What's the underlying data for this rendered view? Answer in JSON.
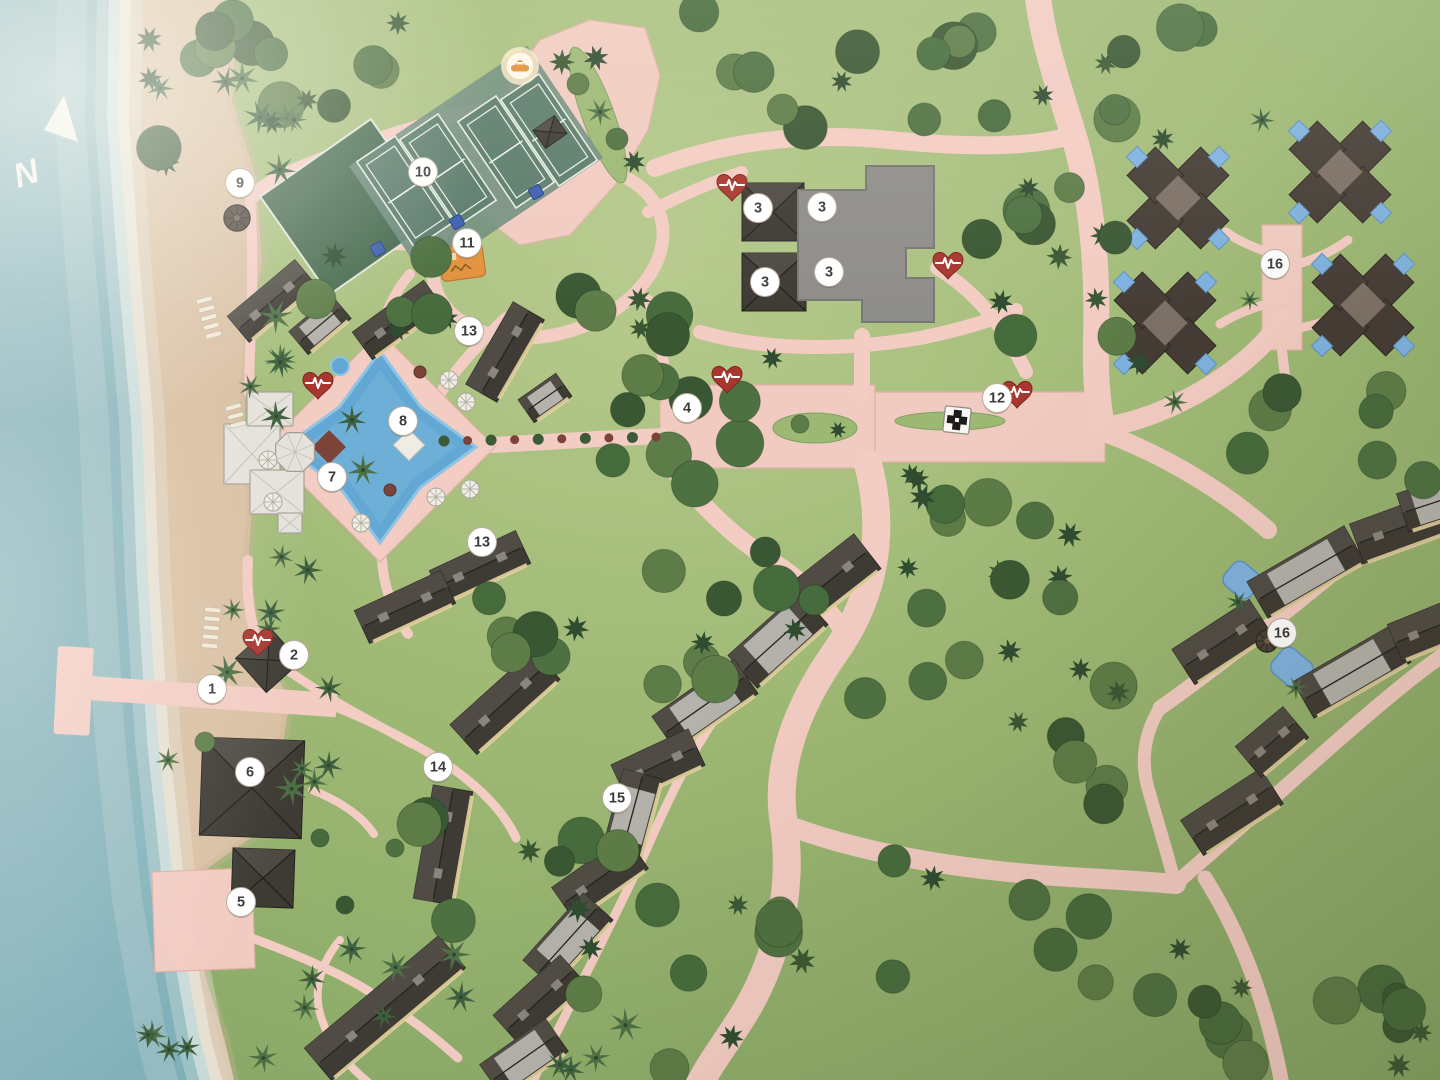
{
  "scene": {
    "width": 1440,
    "height": 1080,
    "kind": "illustrated resort site map (photo)"
  },
  "palette": {
    "ocean_deep": "#7eafb9",
    "ocean_mid": "#8fb7bd",
    "ocean_pale": "#b9d2d2",
    "foam": "#ecf1ea",
    "sand": "#d9c0a3",
    "sand_wet": "#cbb294",
    "grass": "#9db873",
    "grass_light": "#b7ca8d",
    "grass_dark": "#7fa162",
    "forest_dark": "#3a5733",
    "forest_mid": "#4e7141",
    "forest_alt": "#5d7c47",
    "forest_deep": "#2f4c31",
    "palm_green": "#4e7046",
    "palm_dark": "#3f6140",
    "path": "#f3ccc3",
    "path_edge": "#e2b1a6",
    "roof_dark": "#3e3a34",
    "roof_mid": "#57534b",
    "panel_light": "#b4b2ac",
    "trim_cream": "#e3d1a0",
    "flat_roof": "#8e8d8a",
    "flat_edge": "#63625f",
    "white_bldg": "#e4e2db",
    "white_line": "#a09c93",
    "pool_blue": "#63a8d4",
    "pool_light": "#8ec4e4",
    "villa_pool": "#7fb2e0",
    "court_green": "#5c7c6c",
    "court_apron": "#6f8d7d",
    "court_line": "#e9efe8",
    "lawn_green": "#476a4f",
    "marker_bg": "#ffffff",
    "marker_text": "#3b3b3b",
    "marker_ring": "#b9ad9f",
    "aed_red": "#a93730",
    "orange": "#e2923c",
    "maroon": "#7c4338",
    "sign_dark": "#1d1b18"
  },
  "compass": {
    "label": "N"
  },
  "markers": [
    {
      "n": "1",
      "x": 212,
      "y": 689
    },
    {
      "n": "2",
      "x": 294,
      "y": 655
    },
    {
      "n": "3",
      "x": 758,
      "y": 208
    },
    {
      "n": "3",
      "x": 822,
      "y": 207
    },
    {
      "n": "3",
      "x": 765,
      "y": 282
    },
    {
      "n": "3",
      "x": 829,
      "y": 272
    },
    {
      "n": "4",
      "x": 687,
      "y": 408
    },
    {
      "n": "5",
      "x": 241,
      "y": 902
    },
    {
      "n": "6",
      "x": 250,
      "y": 772
    },
    {
      "n": "7",
      "x": 332,
      "y": 477
    },
    {
      "n": "8",
      "x": 403,
      "y": 421
    },
    {
      "n": "9",
      "x": 240,
      "y": 183
    },
    {
      "n": "10",
      "x": 423,
      "y": 172
    },
    {
      "n": "11",
      "x": 467,
      "y": 243
    },
    {
      "n": "12",
      "x": 997,
      "y": 398
    },
    {
      "n": "13",
      "x": 469,
      "y": 331
    },
    {
      "n": "13",
      "x": 482,
      "y": 542
    },
    {
      "n": "14",
      "x": 438,
      "y": 767
    },
    {
      "n": "15",
      "x": 617,
      "y": 798
    },
    {
      "n": "16",
      "x": 1275,
      "y": 264
    },
    {
      "n": "16",
      "x": 1282,
      "y": 633
    }
  ],
  "aed_icons": [
    [
      318,
      385
    ],
    [
      732,
      187
    ],
    [
      948,
      265
    ],
    [
      727,
      379
    ],
    [
      1017,
      394
    ],
    [
      258,
      642
    ]
  ],
  "car_icon": {
    "x": 520,
    "y": 66
  },
  "medic_sign": {
    "x": 957,
    "y": 420
  },
  "terrain": {
    "waterline": [
      [
        120,
        -5
      ],
      [
        118,
        120
      ],
      [
        128,
        260
      ],
      [
        142,
        420
      ],
      [
        148,
        580
      ],
      [
        158,
        740
      ],
      [
        175,
        900
      ],
      [
        200,
        1040
      ],
      [
        212,
        1085
      ]
    ],
    "grassline": [
      [
        238,
        -5
      ],
      [
        232,
        100
      ],
      [
        256,
        178
      ],
      [
        262,
        262
      ],
      [
        248,
        342
      ],
      [
        244,
        424
      ],
      [
        252,
        505
      ],
      [
        247,
        582
      ],
      [
        260,
        645
      ],
      [
        290,
        700
      ],
      [
        280,
        762
      ],
      [
        262,
        830
      ],
      [
        205,
        870
      ],
      [
        195,
        905
      ],
      [
        205,
        975
      ],
      [
        225,
        1040
      ],
      [
        235,
        1085
      ]
    ]
  },
  "plazas": [
    {
      "pts": [
        [
          497,
          100
        ],
        [
          540,
          40
        ],
        [
          590,
          20
        ],
        [
          645,
          28
        ],
        [
          660,
          75
        ],
        [
          648,
          130
        ],
        [
          615,
          185
        ],
        [
          570,
          235
        ],
        [
          520,
          245
        ],
        [
          480,
          215
        ],
        [
          462,
          160
        ]
      ]
    },
    {
      "pts": [
        [
          660,
          385
        ],
        [
          875,
          385
        ],
        [
          875,
          468
        ],
        [
          660,
          468
        ]
      ]
    },
    {
      "pts": [
        [
          875,
          392
        ],
        [
          1105,
          392
        ],
        [
          1105,
          462
        ],
        [
          875,
          462
        ]
      ]
    },
    {
      "pts": [
        [
          1262,
          225
        ],
        [
          1302,
          225
        ],
        [
          1302,
          350
        ],
        [
          1262,
          350
        ]
      ]
    },
    {
      "pts": [
        [
          152,
          872
        ],
        [
          252,
          868
        ],
        [
          255,
          968
        ],
        [
          155,
          972
        ]
      ]
    }
  ],
  "medians": [
    {
      "type": "ellipse",
      "cx": 815,
      "cy": 428,
      "rx": 42,
      "ry": 15,
      "rot": 0
    },
    {
      "type": "ellipse",
      "cx": 950,
      "cy": 421,
      "rx": 55,
      "ry": 9,
      "rot": 0
    },
    {
      "type": "ellipse",
      "cx": 598,
      "cy": 115,
      "rx": 16,
      "ry": 72,
      "rot": -20
    }
  ],
  "roads": [
    {
      "d": "M 1037,-10 C 1042,40 1060,90 1075,140 C 1092,200 1098,270 1096,340 C 1095,375 1098,405 1102,427",
      "w": 26
    },
    {
      "d": "M 655,168 C 730,140 810,132 890,140 C 960,147 1020,148 1062,138",
      "w": 18
    },
    {
      "d": "M 700,332 C 770,352 850,350 920,338 C 960,330 992,320 1016,310",
      "w": 14
    },
    {
      "d": "M 862,336 L 862,394",
      "w": 16
    },
    {
      "d": "M 937,268 C 977,292 1006,330 1026,372",
      "w": 14
    },
    {
      "d": "M 1105,427 C 1150,420 1205,395 1248,358 C 1266,342 1276,330 1282,318",
      "w": 20
    },
    {
      "d": "M 1102,432 C 1165,455 1225,492 1268,530",
      "w": 18
    },
    {
      "d": "M 1160,708 C 1235,655 1320,585 1398,520 C 1420,503 1436,492 1448,486",
      "w": 15
    },
    {
      "d": "M 1175,884 C 1250,820 1332,743 1402,686 C 1424,668 1440,657 1450,650",
      "w": 15
    },
    {
      "d": "M 1160,708 C 1143,735 1140,765 1150,795 C 1158,824 1168,855 1175,884",
      "w": 13
    },
    {
      "d": "M 1205,878 C 1243,938 1268,1008 1282,1085",
      "w": 15
    },
    {
      "d": "M 868,464 C 888,540 870,604 834,654 C 798,706 774,766 784,824 C 794,892 776,962 744,1014 C 724,1046 708,1066 698,1088",
      "w": 28
    },
    {
      "d": "M 666,460 C 700,505 732,536 770,560 C 806,582 832,612 848,638",
      "w": 18
    },
    {
      "d": "M 784,824 C 868,856 976,872 1086,878 C 1122,880 1152,882 1176,884",
      "w": 20
    },
    {
      "d": "M 598,88 C 585,115 572,145 562,172",
      "w": 13
    },
    {
      "d": "M 648,300 C 660,330 664,360 666,392",
      "w": 11
    },
    {
      "d": "M 505,318 C 475,348 453,372 440,394",
      "w": 11
    },
    {
      "d": "M 437,248 C 415,246 395,245 378,244",
      "w": 10
    },
    {
      "d": "M 648,212 C 680,196 712,182 742,172",
      "w": 12
    },
    {
      "d": "M 497,105 C 432,122 362,142 305,166 C 280,176 262,186 252,197",
      "w": 14
    },
    {
      "d": "M 250,197 C 255,260 250,330 249,392",
      "w": 10
    },
    {
      "d": "M 248,560 C 246,592 250,620 258,644",
      "w": 10
    },
    {
      "d": "M 290,672 C 330,700 372,722 412,744",
      "w": 9
    },
    {
      "d": "M 338,708 C 372,722 406,738 440,760 C 480,786 504,812 516,838",
      "w": 9
    },
    {
      "d": "M 252,860 L 246,876",
      "w": 8
    },
    {
      "d": "M 252,938 C 300,956 342,974 370,992 C 408,1016 436,1038 458,1058",
      "w": 9
    },
    {
      "d": "M 312,790 C 342,802 362,816 374,834",
      "w": 8
    },
    {
      "d": "M 850,560 C 806,600 764,650 728,700 C 692,748 668,800 644,855 C 618,910 592,962 568,1010 C 552,1042 540,1064 532,1084",
      "w": 9
    },
    {
      "d": "M 1282,300 C 1256,306 1236,314 1220,324",
      "w": 9
    },
    {
      "d": "M 1282,330 C 1310,328 1332,320 1350,310",
      "w": 9
    },
    {
      "d": "M 1282,256 C 1258,250 1240,242 1226,232",
      "w": 9
    },
    {
      "d": "M 1282,268 C 1310,262 1332,252 1348,240",
      "w": 9
    },
    {
      "d": "M 1282,350 C 1284,372 1287,390 1292,404",
      "w": 10
    },
    {
      "d": "M 492,445 C 550,442 608,438 664,436",
      "w": 16
    },
    {
      "d": "M 382,560 C 384,590 394,614 408,634",
      "w": 10
    },
    {
      "d": "M 380,334 C 386,310 396,290 410,274",
      "w": 10
    },
    {
      "d": "M 340,940 C 320,964 312,992 322,1020 C 330,1044 346,1064 368,1082",
      "w": 8
    }
  ],
  "loop": {
    "cx": 548,
    "cy": 252,
    "rx": 118,
    "ry": 82,
    "rot": -18,
    "w": 13
  },
  "pier": {
    "head": [
      58,
      646,
      36,
      88,
      3
    ],
    "arm": [
      90,
      676,
      248,
      24,
      4
    ]
  },
  "lawn": {
    "cx": 350,
    "cy": 207,
    "w": 135,
    "h": 120,
    "rot": -35
  },
  "court_apron": {
    "cx": 476,
    "cy": 162,
    "w": 215,
    "h": 135,
    "rot": -34
  },
  "courts": [
    [
      405,
      192
    ],
    [
      448,
      170
    ],
    [
      506,
      152
    ],
    [
      549,
      130
    ]
  ],
  "court_size": {
    "w": 46,
    "h": 104,
    "rot": -34
  },
  "playground": {
    "x": 462,
    "y": 262,
    "w": 44,
    "h": 34,
    "rot": -8
  },
  "sport_signs": [
    [
      457,
      222
    ],
    [
      536,
      192
    ],
    [
      378,
      249
    ]
  ],
  "pool": {
    "cx": 380,
    "cy": 447,
    "ro": 96,
    "ri": 57
  },
  "pool_deck": [
    [
      380,
      332
    ],
    [
      495,
      447
    ],
    [
      380,
      562
    ],
    [
      265,
      447
    ]
  ],
  "small_pools": {
    "spa_circle": [
      340,
      366,
      9
    ],
    "maroon_diamond": [
      329,
      447,
      12
    ],
    "white_diamond": [
      409,
      445,
      11
    ],
    "crescent_pools": [
      [
        1242,
        580,
        34,
        30
      ],
      [
        1292,
        668,
        38,
        32
      ]
    ]
  },
  "flat_complex": [
    [
      798,
      190
    ],
    [
      866,
      190
    ],
    [
      866,
      166
    ],
    [
      934,
      166
    ],
    [
      934,
      248
    ],
    [
      906,
      248
    ],
    [
      906,
      278
    ],
    [
      934,
      278
    ],
    [
      934,
      322
    ],
    [
      862,
      322
    ],
    [
      862,
      300
    ],
    [
      798,
      300
    ]
  ],
  "white_bldgs": [
    [
      252,
      454,
      56,
      60
    ],
    [
      270,
      409,
      46,
      34
    ],
    [
      277,
      492,
      54,
      44
    ],
    [
      290,
      523,
      24,
      20
    ]
  ],
  "octagon": {
    "cx": 295,
    "cy": 452,
    "r": 21
  },
  "buildings": [
    [
      272,
      301,
      88,
      34,
      -40,
      "g"
    ],
    [
      320,
      325,
      56,
      30,
      -40,
      "p"
    ],
    [
      398,
      320,
      88,
      34,
      -36,
      "g"
    ],
    [
      505,
      352,
      95,
      36,
      -60,
      "g"
    ],
    [
      545,
      398,
      46,
      28,
      -35,
      "p"
    ],
    [
      480,
      567,
      95,
      36,
      -25,
      "g"
    ],
    [
      405,
      607,
      95,
      36,
      -25,
      "g"
    ],
    [
      385,
      1008,
      175,
      42,
      -40,
      "g"
    ],
    [
      505,
      702,
      112,
      40,
      -42,
      "g"
    ],
    [
      443,
      845,
      115,
      40,
      -80,
      "g"
    ],
    [
      828,
      582,
      100,
      44,
      -38,
      "g"
    ],
    [
      778,
      640,
      95,
      44,
      -42,
      "p"
    ],
    [
      705,
      705,
      100,
      42,
      -35,
      "p"
    ],
    [
      658,
      765,
      85,
      40,
      -25,
      "g"
    ],
    [
      632,
      815,
      85,
      40,
      -75,
      "p"
    ],
    [
      600,
      878,
      90,
      40,
      -35,
      "g"
    ],
    [
      568,
      940,
      90,
      40,
      -48,
      "p"
    ],
    [
      540,
      1000,
      90,
      40,
      -42,
      "g"
    ],
    [
      524,
      1058,
      80,
      40,
      -35,
      "p"
    ],
    [
      1222,
      642,
      92,
      42,
      -33,
      "g"
    ],
    [
      1306,
      572,
      112,
      42,
      -30,
      "p"
    ],
    [
      1400,
      528,
      92,
      42,
      -20,
      "g"
    ],
    [
      1436,
      502,
      70,
      40,
      -18,
      "p"
    ],
    [
      1232,
      812,
      95,
      42,
      -33,
      "g"
    ],
    [
      1272,
      742,
      62,
      40,
      -40,
      "g"
    ],
    [
      1352,
      672,
      112,
      42,
      -30,
      "p"
    ],
    [
      1432,
      628,
      80,
      40,
      -22,
      "g"
    ],
    [
      268,
      660,
      46,
      46,
      -42,
      "h"
    ],
    [
      252,
      788,
      102,
      98,
      2,
      "h"
    ],
    [
      263,
      878,
      62,
      58,
      2,
      "h"
    ],
    [
      773,
      212,
      62,
      58,
      0,
      "h"
    ],
    [
      774,
      282,
      64,
      58,
      0,
      "h"
    ],
    [
      818,
      273,
      24,
      22,
      -30,
      "h"
    ],
    [
      550,
      132,
      26,
      22,
      -35,
      "h"
    ]
  ],
  "villas": {
    "centers": [
      [
        1178,
        198
      ],
      [
        1340,
        172
      ],
      [
        1165,
        323
      ],
      [
        1363,
        305
      ]
    ],
    "arm": 32,
    "arm_size": 40,
    "pool_offset": 58,
    "pool_size": 15
  },
  "palapas": [
    [
      237,
      218,
      13
    ],
    [
      1267,
      641,
      11
    ]
  ],
  "parasols": [
    [
      466,
      402
    ],
    [
      470,
      489
    ],
    [
      268,
      460
    ],
    [
      273,
      502
    ],
    [
      361,
      523
    ],
    [
      449,
      380
    ],
    [
      436,
      497
    ]
  ],
  "loungers": [
    {
      "x": 196,
      "y": 300,
      "rows": 5,
      "rot": -15
    },
    {
      "x": 225,
      "y": 407,
      "rows": 3,
      "rot": -15
    },
    {
      "x": 205,
      "y": 607,
      "rows": 5,
      "rot": 5
    }
  ],
  "bush_row": {
    "x1": 444,
    "y1": 441,
    "x2": 656,
    "y2": 437,
    "n": 10
  },
  "tree_clusters": [
    [
      250,
      15,
      200,
      110,
      9,
      "m"
    ],
    [
      660,
      8,
      350,
      120,
      14,
      "m"
    ],
    [
      1010,
      25,
      210,
      115,
      8,
      "m"
    ],
    [
      140,
      45,
      95,
      125,
      5,
      "m"
    ],
    [
      210,
      65,
      85,
      195,
      6,
      "p"
    ],
    [
      228,
      280,
      70,
      140,
      5,
      "p"
    ],
    [
      222,
      550,
      92,
      140,
      6,
      "p"
    ],
    [
      258,
      688,
      84,
      140,
      5,
      "p"
    ],
    [
      295,
      945,
      170,
      125,
      7,
      "p"
    ],
    [
      150,
      1010,
      130,
      65,
      4,
      "p"
    ],
    [
      470,
      1010,
      170,
      65,
      4,
      "p"
    ],
    [
      300,
      252,
      160,
      95,
      7,
      "m"
    ],
    [
      548,
      292,
      230,
      185,
      15,
      "m"
    ],
    [
      636,
      468,
      440,
      245,
      26,
      "m"
    ],
    [
      462,
      556,
      130,
      120,
      6,
      "m"
    ],
    [
      948,
      168,
      160,
      175,
      9,
      "m"
    ],
    [
      1088,
      128,
      62,
      235,
      5,
      "m"
    ],
    [
      1240,
      368,
      190,
      125,
      8,
      "m"
    ],
    [
      885,
      600,
      300,
      420,
      18,
      "m"
    ],
    [
      1200,
      905,
      210,
      160,
      8,
      "m"
    ],
    [
      1340,
      990,
      95,
      85,
      4,
      "m"
    ],
    [
      418,
      798,
      210,
      205,
      10,
      "m"
    ],
    [
      648,
      898,
      210,
      175,
      9,
      "m"
    ],
    [
      130,
      0,
      110,
      50,
      3,
      "m"
    ]
  ],
  "tree_singles": [
    [
      562,
      62,
      "s",
      13
    ],
    [
      596,
      58,
      "s",
      13
    ],
    [
      578,
      84,
      "r",
      11
    ],
    [
      600,
      112,
      "p",
      14
    ],
    [
      617,
      139,
      "r",
      11
    ],
    [
      634,
      162,
      "s",
      12
    ],
    [
      800,
      424,
      "r",
      9
    ],
    [
      838,
      430,
      "s",
      9
    ],
    [
      352,
      420,
      "p",
      15
    ],
    [
      363,
      470,
      "p",
      16
    ],
    [
      1238,
      602,
      "p",
      12
    ],
    [
      1296,
      688,
      "p",
      12
    ],
    [
      1262,
      120,
      "p",
      13
    ],
    [
      1250,
      300,
      "p",
      11
    ],
    [
      160,
      88,
      "p",
      14
    ],
    [
      168,
      760,
      "p",
      13
    ],
    [
      148,
      1035,
      "p",
      13
    ],
    [
      795,
      630,
      "s",
      12
    ],
    [
      1018,
      722,
      "s",
      11
    ],
    [
      908,
      568,
      "s",
      11
    ],
    [
      738,
      905,
      "s",
      11
    ],
    [
      1175,
      402,
      "p",
      13
    ],
    [
      205,
      742,
      "r",
      10
    ],
    [
      320,
      838,
      "r",
      9
    ],
    [
      395,
      848,
      "r",
      9
    ],
    [
      345,
      905,
      "r",
      9
    ],
    [
      390,
      490,
      "b",
      6
    ],
    [
      420,
      372,
      "b",
      6
    ]
  ]
}
